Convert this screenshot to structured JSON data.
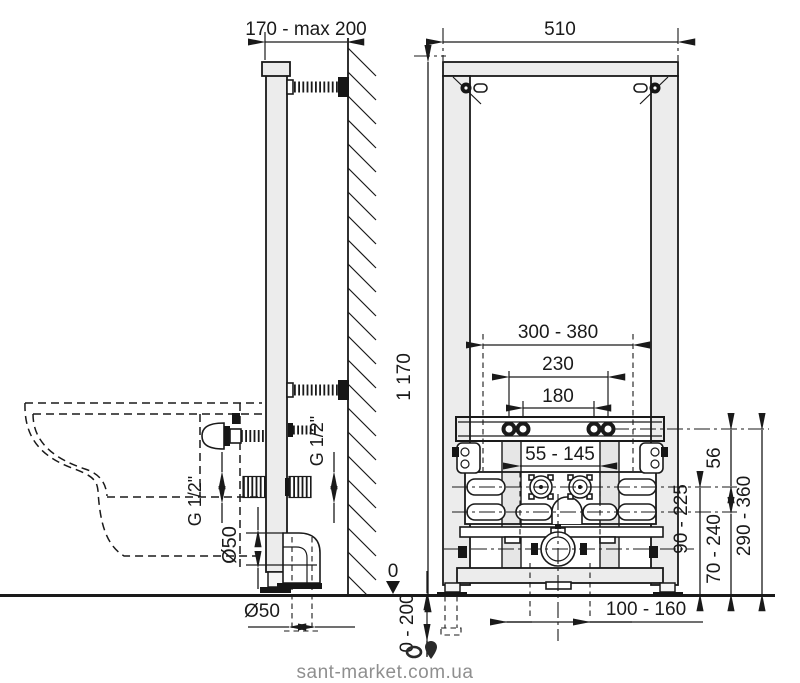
{
  "watermark": {
    "text": "sant-market.com.ua"
  },
  "side_view": {
    "dim_wall_offset": "170 - max 200",
    "water_thread_left": "G 1/2\"",
    "water_thread_right": "G 1/2\"",
    "drain_pipe_side": "Ø50",
    "drain_pipe_bottom": "Ø50"
  },
  "front_view": {
    "dim_frame_width": "510",
    "dim_frame_height": "1 170",
    "dim_bracket_range": "300 - 380",
    "dim_bolt_spacing_outer": "230",
    "dim_bolt_spacing_inner": "180",
    "dim_water_adjust": "55 - 145",
    "dim_rail_to_water": "56",
    "dim_water_height": "90 - 225",
    "dim_drain_height": "70 - 240",
    "dim_bolt_height": "290 - 360",
    "floor_zero": "0",
    "dim_feet_adjust": "0 - 200",
    "dim_drain_offset": "100 - 160"
  }
}
